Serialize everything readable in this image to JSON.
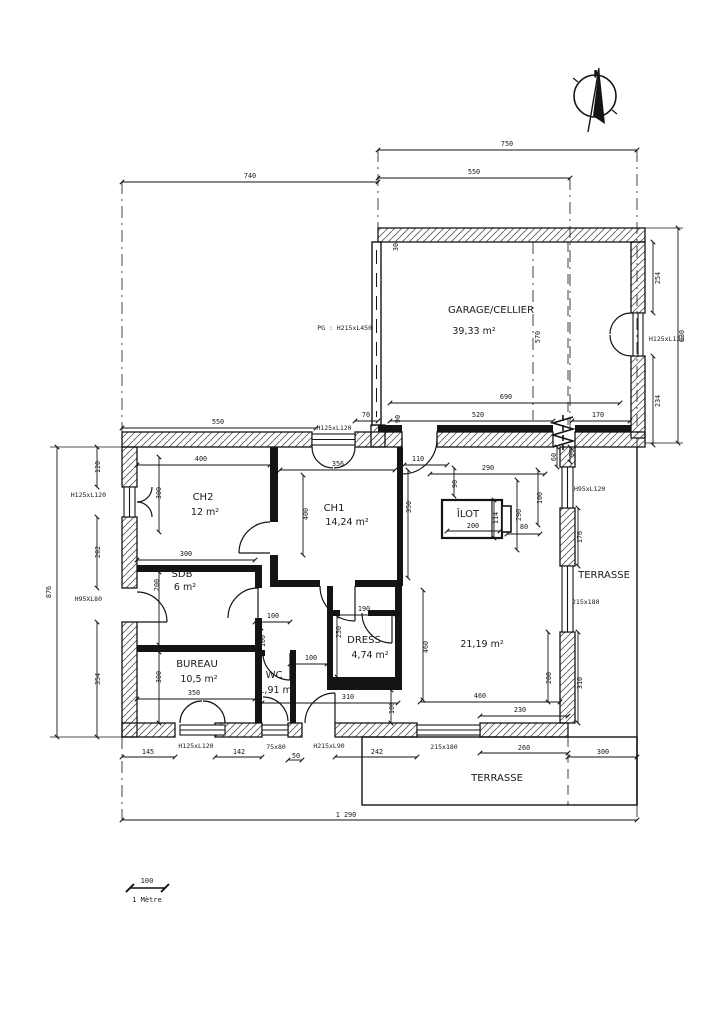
{
  "plan": {
    "compass": {
      "label": "N"
    },
    "scale_bar": {
      "length": "100",
      "unit": "1 Mètre"
    },
    "rooms": [
      {
        "name": "GARAGE/CELLIER",
        "area": "39,33 m²",
        "x": 491,
        "y": 313,
        "ax": 474,
        "ay": 334
      },
      {
        "name": "CH2",
        "area": "12 m²",
        "x": 203,
        "y": 500,
        "ax": 205,
        "ay": 515
      },
      {
        "name": "CH1",
        "area": "14,24 m²",
        "x": 334,
        "y": 511,
        "ax": 347,
        "ay": 525
      },
      {
        "name": "SDB",
        "area": "6 m²",
        "x": 182,
        "y": 577,
        "ax": 185,
        "ay": 590
      },
      {
        "name": "BUREAU",
        "area": "10,5 m²",
        "x": 197,
        "y": 667,
        "ax": 199,
        "ay": 682
      },
      {
        "name": "WC",
        "area": "1,91 m²",
        "x": 274,
        "y": 678,
        "ax": 277,
        "ay": 693
      },
      {
        "name": "DRESS",
        "area": "4,74 m²",
        "x": 364,
        "y": 643,
        "ax": 370,
        "ay": 658
      },
      {
        "name": "",
        "area": "21,19 m²",
        "x": 482,
        "y": 647,
        "ax": 482,
        "ay": 647
      }
    ],
    "zone_labels": [
      {
        "text": "ÎLOT",
        "x": 468,
        "y": 517
      },
      {
        "text": "TERRASSE",
        "x": 604,
        "y": 578
      },
      {
        "text": "TERRASSE",
        "x": 497,
        "y": 781
      }
    ],
    "opening_labels": [
      {
        "text": "PG : H215xL450",
        "x": 372,
        "y": 330,
        "anchor": "end"
      },
      {
        "text": "H125xL120",
        "x": 649,
        "y": 341,
        "anchor": "start"
      },
      {
        "text": "H125xL120",
        "x": 334,
        "y": 430
      },
      {
        "text": "H125xL120",
        "x": 106,
        "y": 497,
        "anchor": "end"
      },
      {
        "text": "H95XL80",
        "x": 102,
        "y": 601,
        "anchor": "end"
      },
      {
        "text": "H95xL120",
        "x": 574,
        "y": 491,
        "anchor": "start"
      },
      {
        "text": "215x180",
        "x": 572,
        "y": 604,
        "anchor": "start"
      },
      {
        "text": "H125xL120",
        "x": 196,
        "y": 748
      },
      {
        "text": "75x80",
        "x": 276,
        "y": 749
      },
      {
        "text": "H215xL90",
        "x": 329,
        "y": 748
      },
      {
        "text": "215x180",
        "x": 444,
        "y": 749
      }
    ],
    "dimension_labels": [
      {
        "text": "750",
        "x": 507,
        "y": 146
      },
      {
        "text": "550",
        "x": 474,
        "y": 174
      },
      {
        "text": "740",
        "x": 250,
        "y": 178
      },
      {
        "text": "630",
        "x": 684,
        "y": 336,
        "r": -90
      },
      {
        "text": "254",
        "x": 660,
        "y": 278,
        "r": -90
      },
      {
        "text": "234",
        "x": 660,
        "y": 401,
        "r": -90
      },
      {
        "text": "570",
        "x": 540,
        "y": 337,
        "r": -90
      },
      {
        "text": "30",
        "x": 398,
        "y": 247,
        "r": -90
      },
      {
        "text": "690",
        "x": 506,
        "y": 399
      },
      {
        "text": "520",
        "x": 478,
        "y": 417
      },
      {
        "text": "170",
        "x": 598,
        "y": 417
      },
      {
        "text": "90",
        "x": 400,
        "y": 419,
        "r": -90
      },
      {
        "text": "550",
        "x": 218,
        "y": 424
      },
      {
        "text": "70",
        "x": 366,
        "y": 417
      },
      {
        "text": "110",
        "x": 418,
        "y": 461
      },
      {
        "text": "290",
        "x": 488,
        "y": 470
      },
      {
        "text": "90",
        "x": 457,
        "y": 484,
        "r": -90
      },
      {
        "text": "60",
        "x": 556,
        "y": 457,
        "r": -90
      },
      {
        "text": "90",
        "x": 574,
        "y": 453,
        "r": -90
      },
      {
        "text": "400",
        "x": 201,
        "y": 461
      },
      {
        "text": "356",
        "x": 338,
        "y": 466
      },
      {
        "text": "400",
        "x": 308,
        "y": 514,
        "r": -90
      },
      {
        "text": "350",
        "x": 411,
        "y": 507,
        "r": -90
      },
      {
        "text": "290",
        "x": 521,
        "y": 515,
        "r": -90
      },
      {
        "text": "114",
        "x": 498,
        "y": 518,
        "r": -90
      },
      {
        "text": "100",
        "x": 542,
        "y": 498,
        "r": -90
      },
      {
        "text": "200",
        "x": 473,
        "y": 528
      },
      {
        "text": "80",
        "x": 524,
        "y": 529
      },
      {
        "text": "176",
        "x": 582,
        "y": 537,
        "r": -90
      },
      {
        "text": "300",
        "x": 161,
        "y": 493,
        "r": -90
      },
      {
        "text": "200",
        "x": 159,
        "y": 585,
        "r": -90
      },
      {
        "text": "300",
        "x": 161,
        "y": 677,
        "r": -90
      },
      {
        "text": "876",
        "x": 51,
        "y": 592,
        "r": -90
      },
      {
        "text": "120",
        "x": 100,
        "y": 467,
        "r": -90
      },
      {
        "text": "202",
        "x": 100,
        "y": 552,
        "r": -90
      },
      {
        "text": "354",
        "x": 100,
        "y": 679,
        "r": -90
      },
      {
        "text": "300",
        "x": 186,
        "y": 556
      },
      {
        "text": "100",
        "x": 273,
        "y": 618
      },
      {
        "text": "190",
        "x": 364,
        "y": 611
      },
      {
        "text": "250",
        "x": 341,
        "y": 632,
        "r": -90
      },
      {
        "text": "100",
        "x": 265,
        "y": 641,
        "r": -90
      },
      {
        "text": "100",
        "x": 311,
        "y": 660
      },
      {
        "text": "350",
        "x": 194,
        "y": 695
      },
      {
        "text": "310",
        "x": 348,
        "y": 699
      },
      {
        "text": "100",
        "x": 394,
        "y": 708,
        "r": -90
      },
      {
        "text": "460",
        "x": 480,
        "y": 698
      },
      {
        "text": "230",
        "x": 520,
        "y": 712
      },
      {
        "text": "460",
        "x": 428,
        "y": 647,
        "r": -90
      },
      {
        "text": "310",
        "x": 582,
        "y": 683,
        "r": -90
      },
      {
        "text": "280",
        "x": 551,
        "y": 678,
        "r": -90
      },
      {
        "text": "145",
        "x": 148,
        "y": 754
      },
      {
        "text": "142",
        "x": 239,
        "y": 754
      },
      {
        "text": "50",
        "x": 296,
        "y": 758
      },
      {
        "text": "242",
        "x": 377,
        "y": 754
      },
      {
        "text": "260",
        "x": 524,
        "y": 750
      },
      {
        "text": "300",
        "x": 603,
        "y": 754
      },
      {
        "text": "1 290",
        "x": 346,
        "y": 817
      }
    ]
  }
}
